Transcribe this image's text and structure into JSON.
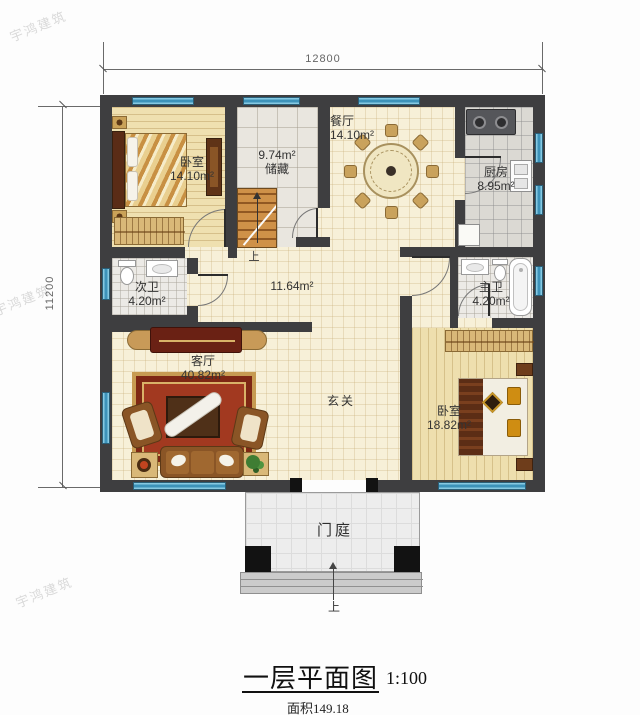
{
  "watermark": "宇鸿建筑",
  "dimensions": {
    "top": "12800",
    "left": "11200"
  },
  "rooms": {
    "bedroom_top_left": {
      "name": "卧室",
      "area": "14.10m²"
    },
    "storage": {
      "name": "储藏",
      "area": "9.74m²"
    },
    "dining": {
      "name": "餐厅",
      "area": "14.10m²"
    },
    "kitchen": {
      "name": "厨房",
      "area": "8.95m²"
    },
    "bath_second": {
      "name": "次卫",
      "area": "4.20m²"
    },
    "hallway": {
      "area": "11.64m²"
    },
    "bath_master": {
      "name": "主卫",
      "area": "4.20m²"
    },
    "living": {
      "name": "客厅",
      "area": "40.82m²"
    },
    "foyer": {
      "name": "玄关"
    },
    "bedroom_right": {
      "name": "卧室",
      "area": "18.82m²"
    },
    "porch": {
      "name": "门庭"
    }
  },
  "stairs_up": "上",
  "entrance_up": "上",
  "title": {
    "text": "一层平面图",
    "scale": "1:100",
    "area_note": "面积149.18"
  },
  "colors": {
    "wall": "#3e3e40",
    "window_blue": "#3d93ba",
    "rug_red": "#a23920",
    "wood_floor": "#efe0b0"
  }
}
